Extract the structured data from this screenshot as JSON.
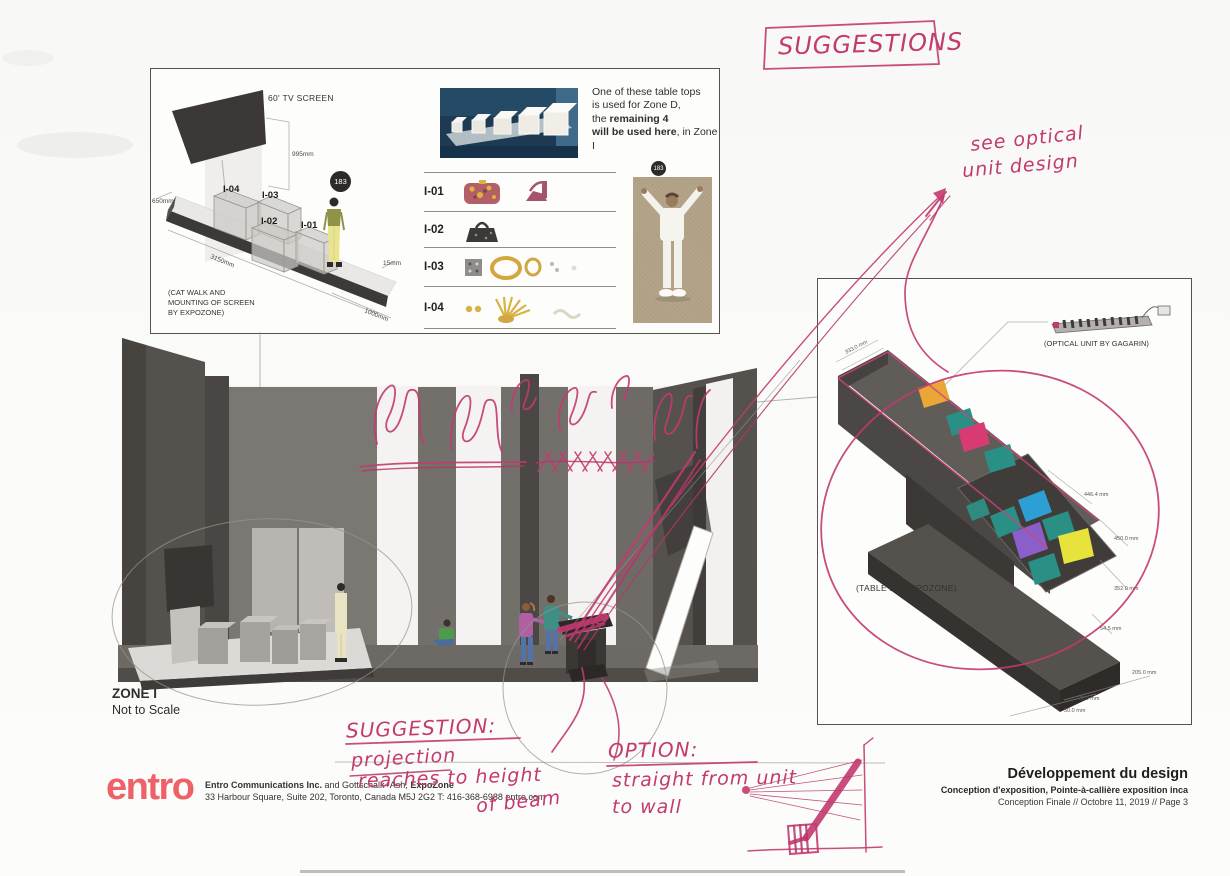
{
  "catwalk_panel": {
    "screen_label": "60' TV SCREEN",
    "badge": "183",
    "box_labels": [
      "I-04",
      "I-03",
      "I-02",
      "I-01"
    ],
    "dims": {
      "height": "995mm",
      "left": "650mm",
      "length": "3150mm",
      "lip": "15mm",
      "width": "1000mm"
    },
    "note_line1": "(CAT WALK AND",
    "note_line2": "MOUNTING OF SCREEN",
    "note_line3": "BY EXPOZONE)"
  },
  "items_panel": {
    "caption": {
      "l1": "One of these table tops",
      "l2": "is used for Zone D,",
      "l3_pre": "the ",
      "l3_bold": "remaining 4",
      "l4_bold": "will be used here",
      "l4_post": ", in Zone I"
    },
    "badge": "183",
    "rows": [
      {
        "label": "I-01"
      },
      {
        "label": "I-02"
      },
      {
        "label": "I-03"
      },
      {
        "label": "I-04"
      }
    ]
  },
  "zone": {
    "title": "ZONE I",
    "subtitle": "Not to Scale"
  },
  "table_panel": {
    "optical_label": "(OPTICAL UNIT BY GAGARIN)",
    "table_label": "(TABLE BY EXPOZONE)",
    "dims": [
      "333.0 mm",
      "446.4 mm",
      "450.0 mm",
      "352.0 mm",
      "54.5 mm",
      "205.0 mm",
      "72.0 mm",
      "50.0 mm"
    ]
  },
  "handwriting": {
    "suggestions": "SUGGESTIONS",
    "see_optical_1": "see optical",
    "see_optical_2": "unit design",
    "suggestion_title": "SUGGESTION:",
    "suggestion_l1": "projection",
    "suggestion_l2": "reaches to height",
    "suggestion_l3": "of beam",
    "option_title": "OPTION:",
    "option_l1": "straight from unit",
    "option_l2": "to wall"
  },
  "footer": {
    "logo": "entro",
    "company_bold1": "Entro Communications Inc.",
    "company_mid": " and Gottschalk+Ash, ",
    "company_bold2": "ExpoZone",
    "address": "33 Harbour Square, Suite 202, Toronto, Canada  M5J 2G2  T: 416-368-6988  entro.com",
    "doc_title": "Développement du design",
    "doc_subtitle": "Conception d'exposition, Pointe-à-callière exposition inca",
    "doc_meta": "Conception Finale // Octobre 11, 2019 // Page 3"
  },
  "colors": {
    "marker_pink": "#c23a6f",
    "pencil_grey": "#97948f",
    "entro_red": "#ee6168",
    "wall_dark": "#55524e",
    "square_orange": "#eaa636",
    "square_teal": "#2a8f84",
    "square_pink": "#d83a74",
    "square_blue": "#2e9fd4",
    "square_purple": "#8a5fc8",
    "square_yellow": "#e8e33c"
  }
}
